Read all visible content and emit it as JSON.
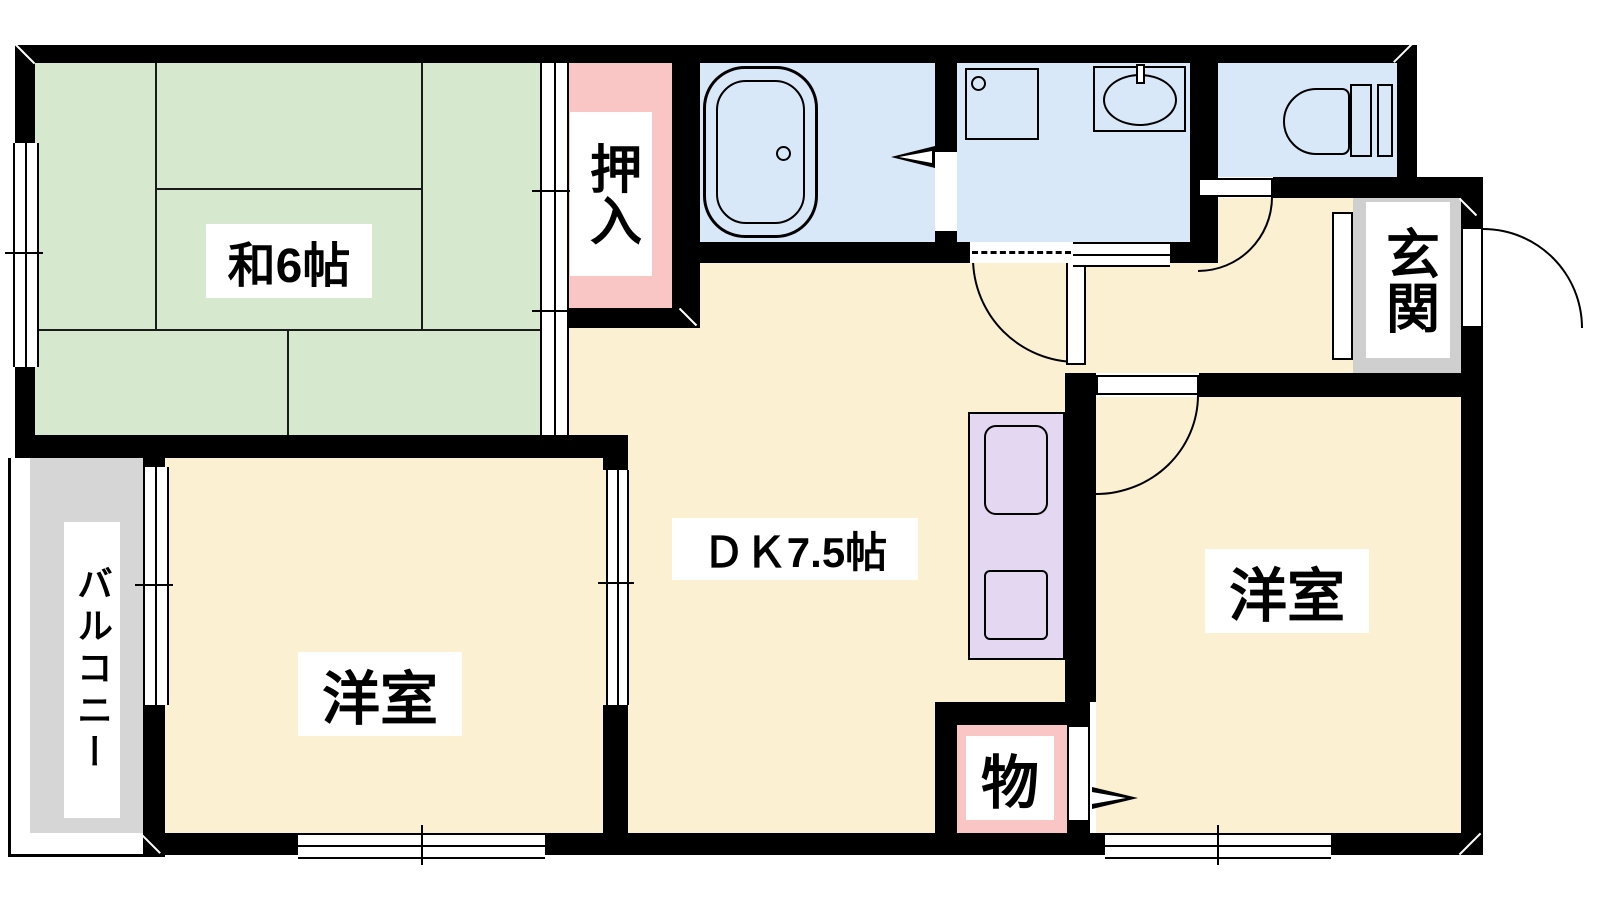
{
  "plan": {
    "title": "apartment-floor-plan",
    "rooms": {
      "washitsu": {
        "label": "和6帖"
      },
      "oshiire": {
        "label": "押入"
      },
      "dk": {
        "label": "ＤＫ7.5帖"
      },
      "youshitsu_left": {
        "label": "洋室"
      },
      "youshitsu_right": {
        "label": "洋室"
      },
      "storage": {
        "label": "物"
      },
      "genkan": {
        "label": "玄関"
      },
      "balcony": {
        "label": "バルコニー"
      }
    },
    "colors": {
      "wall": "#000000",
      "tatami_green": "#d6e8ce",
      "flooring_cream": "#fcf0d2",
      "wet_area_blue": "#d9e8f9",
      "closet_pink": "#f9c5c5",
      "kitchen_lavender": "#e3d7f2",
      "genkan_gray": "#cfcfcf",
      "balcony_gray": "#d6d6d6"
    }
  }
}
